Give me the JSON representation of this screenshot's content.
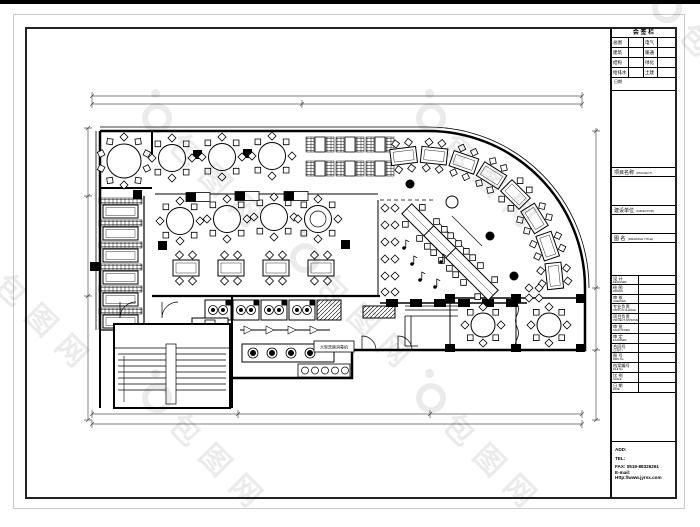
{
  "watermark": {
    "text": "包图网",
    "logo": "ib"
  },
  "title_block": {
    "huiqian": {
      "header": "会 签 栏",
      "rows": [
        {
          "l": "总图",
          "r": "电气"
        },
        {
          "l": "建筑",
          "r": "暖通"
        },
        {
          "l": "结构",
          "r": "绿化"
        },
        {
          "l": "给排水",
          "r": "土建"
        }
      ],
      "footer": "日期"
    },
    "sections": {
      "project": {
        "label": "项目名称",
        "sub": "(PROJECT)"
      },
      "client": {
        "label": "建设单位",
        "sub": "(DIRECTOR)"
      },
      "drawing": {
        "label": "图 名",
        "sub": "(DRAWING TITLE)"
      }
    },
    "rows": [
      {
        "label": "设 计",
        "sub": "DESIGNED"
      },
      {
        "label": "绘 图",
        "sub": "DRAWN"
      },
      {
        "label": "审 核",
        "sub": "CHECKED"
      },
      {
        "label": "专业负责",
        "sub": "PROF. IN CHARGE"
      },
      {
        "label": "项目负责",
        "sub": "PROJECT APPROVED"
      },
      {
        "label": "审 批",
        "sub": "SANCTIONED"
      },
      {
        "label": "审 定",
        "sub": "EXAMINED"
      },
      {
        "label": "合同号",
        "sub": "(工程号)"
      },
      {
        "label": "图 号",
        "sub": "DWG No."
      },
      {
        "label": "档案编号",
        "sub": "FILE No."
      },
      {
        "label": "比 例",
        "sub": "SCALE"
      },
      {
        "label": "日 期",
        "sub": "DATE"
      }
    ],
    "contact": {
      "add": "ADD:",
      "tel": "TEL:",
      "fax": "FAX: 0519-88326261",
      "email": "E-mail:",
      "web": "Http://www.jyrsx.com"
    }
  },
  "plan": {
    "labels": {
      "dishwasher": "大型洗碗消毒机"
    }
  }
}
